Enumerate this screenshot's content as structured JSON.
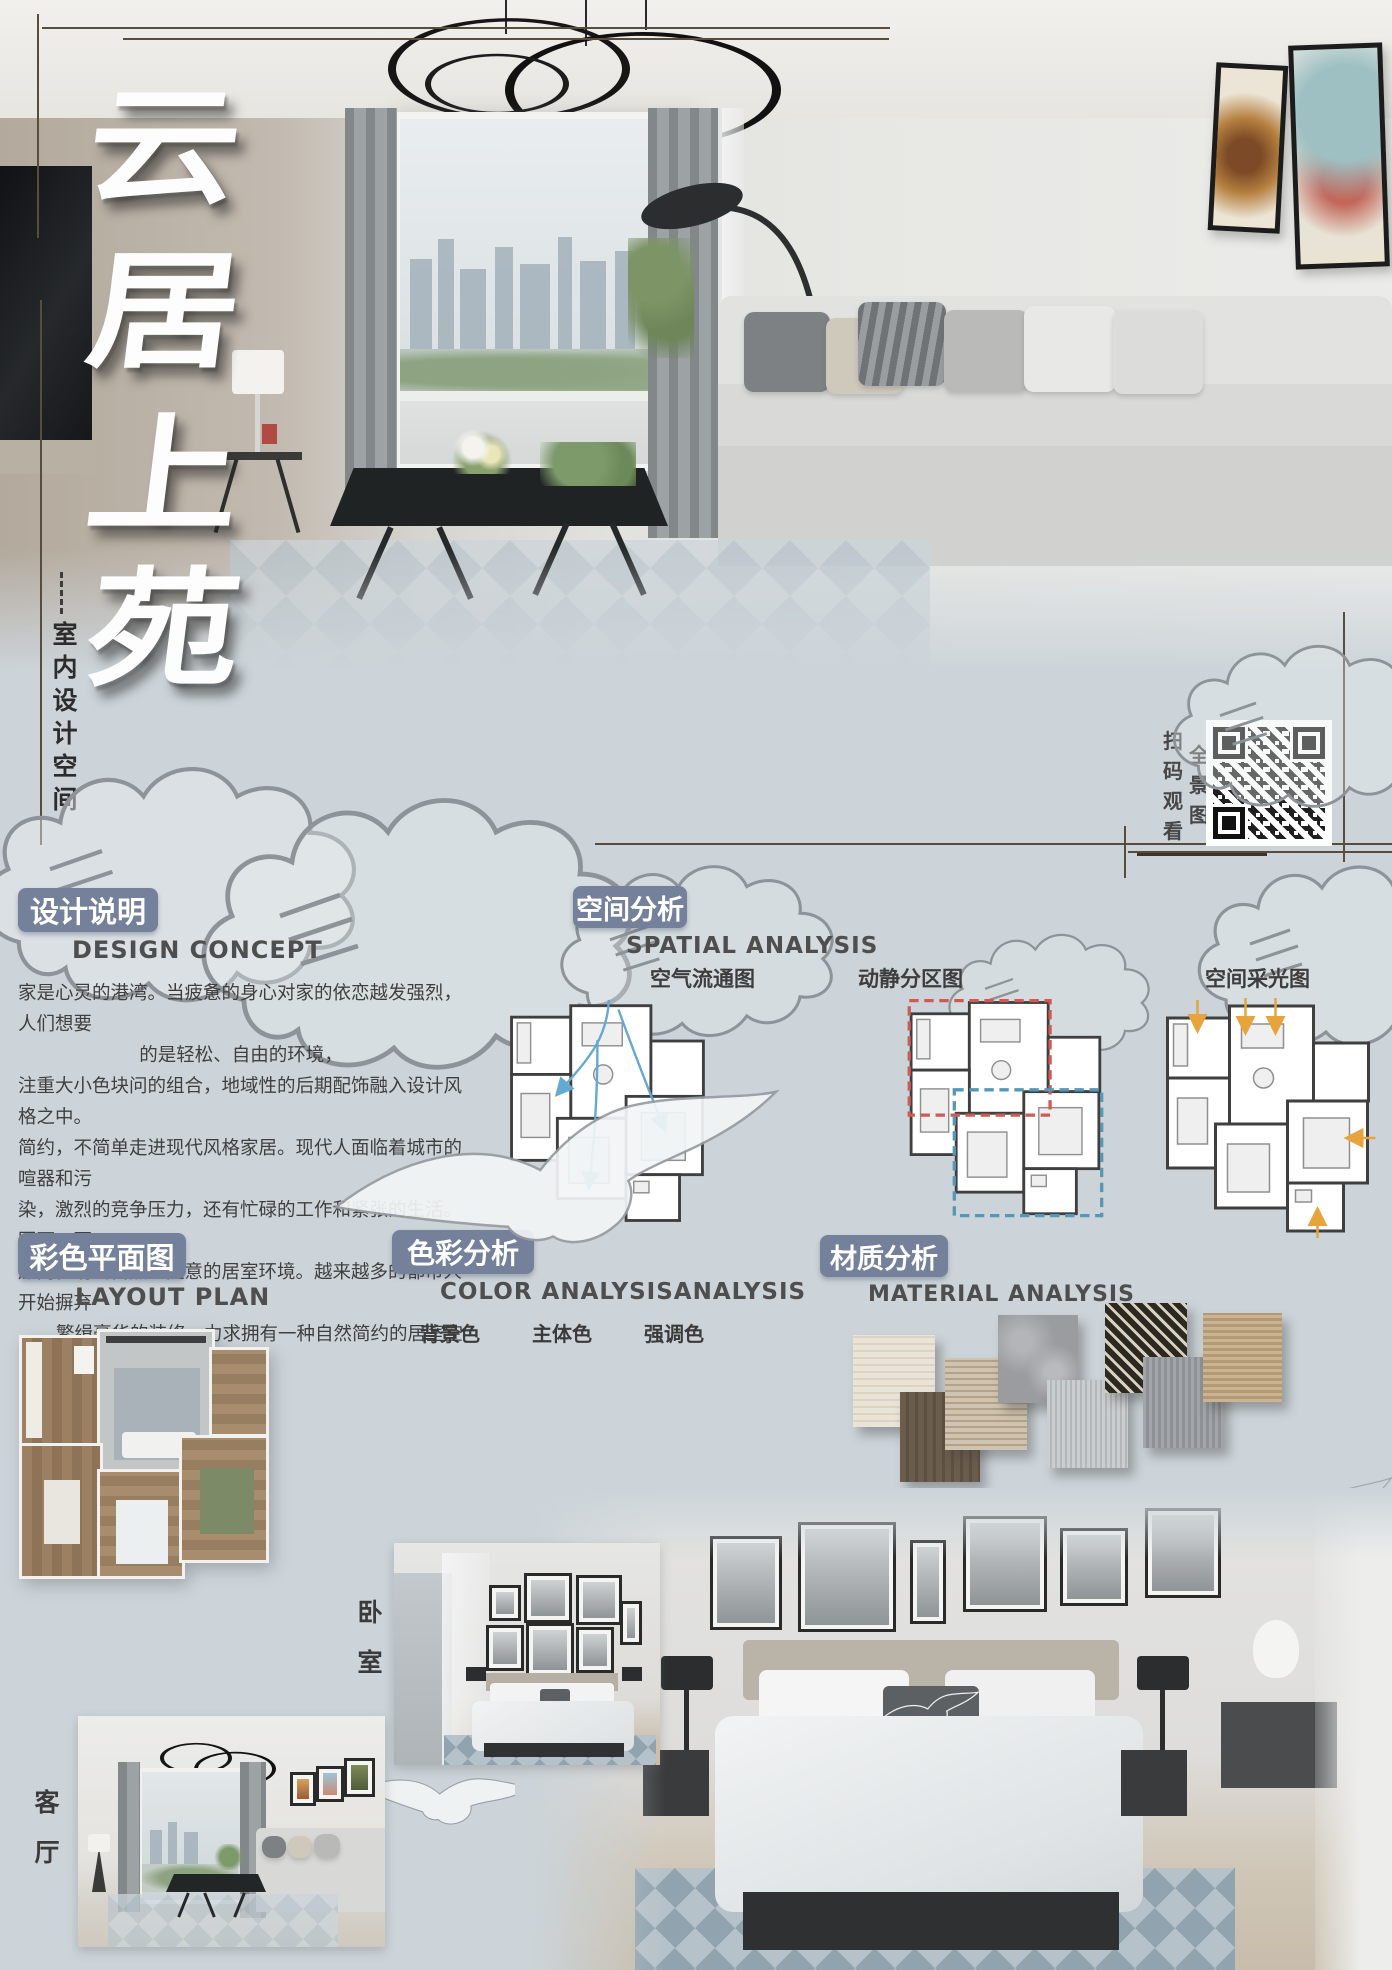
{
  "poster": {
    "title_chars": [
      "云",
      "居",
      "上",
      "苑"
    ],
    "subtitle_vertical": "室内设计空间",
    "qr_caption_col1": "扫码观看",
    "qr_caption_col2": "全景图",
    "photo_labels": {
      "bedroom": "卧室",
      "living_room": "客厅"
    },
    "colors": {
      "page_background": "#ccd4d9",
      "heading_accent": "#75819b",
      "crop_line": "#584c3c",
      "airflow_arrow": "#64a9cf",
      "active_zone": "#cf5a52",
      "quiet_zone": "#5597b5",
      "daylight_arrow": "#e7a33c"
    }
  },
  "design_concept": {
    "heading_zh": "设计说明",
    "heading_en": "DESIGN CONCEPT",
    "lines": [
      "家是心灵的港湾。当疲惫的身心对家的依恋越发强烈，人们想要",
      "的是轻松、自由的环境，",
      "注重大小色块问的组合，地域性的后期配饰融入设计风格之中。",
      "简约，不简单走进现代风格家居。现代人面临着城市的喧器和污",
      "染，激烈的竞争压力，还有忙碌的工作和紧张的生活。因面，更",
      "加向往清新自然、随意的居室环境。越来越多的都市人开始摒弃",
      "繁缉豪华的装修，力求拥有一种自然简约的居室空间。"
    ]
  },
  "spatial_analysis": {
    "heading_zh": "空间分析",
    "heading_en": "SPATIAL ANALYSIS",
    "diagram_labels": [
      "空气流通图",
      "动静分区图",
      "空间采光图"
    ]
  },
  "layout_plan": {
    "heading_zh": "彩色平面图",
    "heading_en": "LAYOUT PLAN"
  },
  "color_analysis": {
    "heading_zh": "色彩分析",
    "heading_en": "COLOR ANALYSISANALYSIS",
    "swatches": [
      {
        "label": "背景色",
        "value": "60%",
        "color": "#d3d0c9"
      },
      {
        "label": "主体色",
        "value": "30%",
        "color": "#a8a8a8"
      },
      {
        "label": "强调色",
        "value": "10%",
        "color": "#3d4954"
      }
    ]
  },
  "material_analysis": {
    "heading_zh": "材质分析",
    "heading_en": "MATERIAL ANALYSIS"
  }
}
